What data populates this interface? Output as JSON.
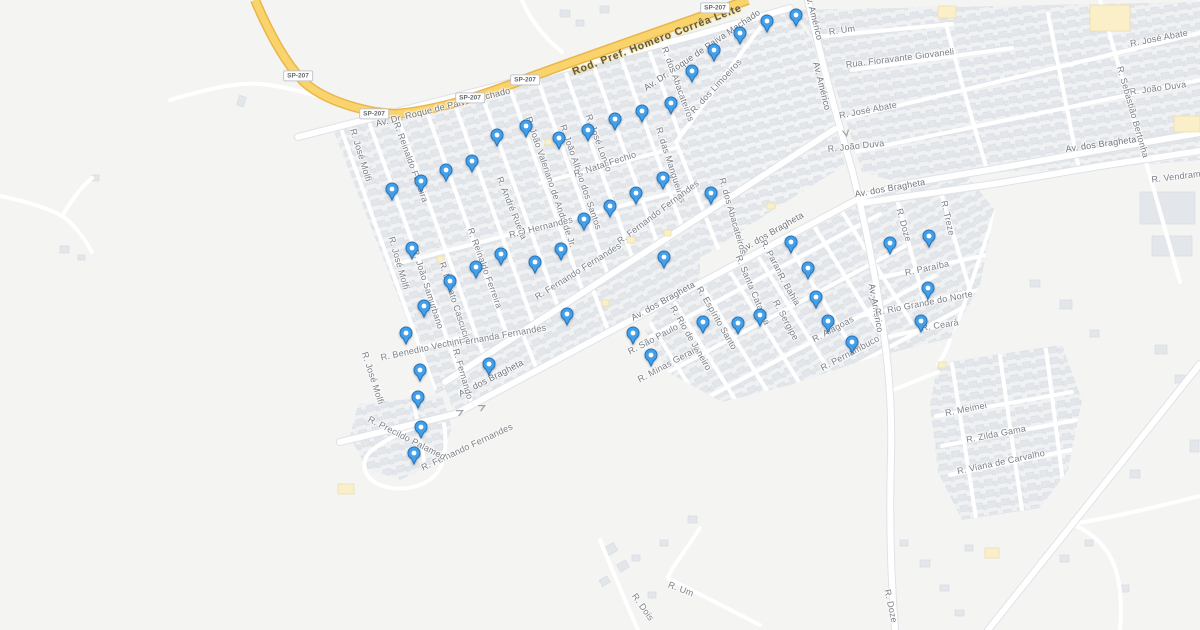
{
  "map": {
    "colors": {
      "land": "#F4F5F2",
      "block": "#EFF1F3",
      "building": "#E3E6EA",
      "building_stroke": "#D8DCE1",
      "road": "#FFFFFF",
      "road_casing": "#DFE2E6",
      "highway_fill": "#F9D46C",
      "highway_casing": "#EBB54B",
      "poi_building": "#FAEFC9",
      "label": "#7B7F87",
      "highway_label": "#5D5944",
      "marker_fill": "#43A0E8",
      "marker_stroke": "#2273BF",
      "marker_dot": "#FFFFFF"
    },
    "shields": [
      {
        "text": "SP-207",
        "x": 298,
        "y": 76
      },
      {
        "text": "SP-207",
        "x": 374,
        "y": 114
      },
      {
        "text": "SP-207",
        "x": 470,
        "y": 98
      },
      {
        "text": "SP-207",
        "x": 525,
        "y": 80
      },
      {
        "text": "SP-207",
        "x": 715,
        "y": 8
      }
    ],
    "labels": [
      {
        "text": "Rod. Pref. Homero Corrêa Leite",
        "x": 657,
        "y": 40,
        "r": -21,
        "kind": "highway"
      },
      {
        "text": "Av. Dr. Roque de Paiva Machado",
        "x": 443,
        "y": 107,
        "r": -14,
        "kind": "avenue"
      },
      {
        "text": "Av. Dr. Roque de Paiva Machado",
        "x": 702,
        "y": 50,
        "r": -34,
        "kind": "avenue"
      },
      {
        "text": "Av. dos Bragheta",
        "x": 491,
        "y": 378,
        "r": -27,
        "kind": "avenue"
      },
      {
        "text": "Av. dos Bragheta",
        "x": 663,
        "y": 301,
        "r": -29,
        "kind": "avenue"
      },
      {
        "text": "Av. dos Bragheta",
        "x": 772,
        "y": 232,
        "r": -30,
        "kind": "avenue"
      },
      {
        "text": "Av. dos Bragheta",
        "x": 890,
        "y": 188,
        "r": -10,
        "kind": "avenue"
      },
      {
        "text": "Av. dos Bragheta",
        "x": 1101,
        "y": 144,
        "r": -8,
        "kind": "avenue"
      },
      {
        "text": "Av. Américo",
        "x": 814,
        "y": 16,
        "r": 76,
        "kind": "avenue"
      },
      {
        "text": "Av. Américo",
        "x": 822,
        "y": 86,
        "r": 76,
        "kind": "avenue"
      },
      {
        "text": "Av. Américo",
        "x": 876,
        "y": 308,
        "r": 80,
        "kind": "avenue"
      },
      {
        "text": "R. José Molfi",
        "x": 361,
        "y": 155,
        "r": 73,
        "kind": "street"
      },
      {
        "text": "R. José Molfi",
        "x": 399,
        "y": 263,
        "r": 74,
        "kind": "street"
      },
      {
        "text": "R. José Molfi",
        "x": 373,
        "y": 378,
        "r": 72,
        "kind": "street"
      },
      {
        "text": "R. Reinaldo Ferreira",
        "x": 411,
        "y": 162,
        "r": 70,
        "kind": "street"
      },
      {
        "text": "R. Reinaldo Ferreira",
        "x": 485,
        "y": 268,
        "r": 70,
        "kind": "street"
      },
      {
        "text": "R. João Samurbano",
        "x": 428,
        "y": 289,
        "r": 72,
        "kind": "street"
      },
      {
        "text": "R. Donato Cascucio",
        "x": 455,
        "y": 302,
        "r": 72,
        "kind": "street"
      },
      {
        "text": "R. André Rueda",
        "x": 512,
        "y": 208,
        "r": 68,
        "kind": "street"
      },
      {
        "text": "R. João Valeriano de Andrade Jr.",
        "x": 551,
        "y": 182,
        "r": 71,
        "kind": "street"
      },
      {
        "text": "R. João Albino dos Santos",
        "x": 581,
        "y": 177,
        "r": 71,
        "kind": "street"
      },
      {
        "text": "R. José Longo",
        "x": 599,
        "y": 143,
        "r": 70,
        "kind": "street"
      },
      {
        "text": "R. Natal Fechio",
        "x": 605,
        "y": 164,
        "r": -18,
        "kind": "street"
      },
      {
        "text": "R. das Mangueiras",
        "x": 671,
        "y": 165,
        "r": 72,
        "kind": "street"
      },
      {
        "text": "R. dos Abacateiros",
        "x": 678,
        "y": 84,
        "r": 70,
        "kind": "street"
      },
      {
        "text": "R. dos Abacateiros",
        "x": 733,
        "y": 216,
        "r": 74,
        "kind": "street"
      },
      {
        "text": "R. dos Limoeiros",
        "x": 716,
        "y": 86,
        "r": -47,
        "kind": "street"
      },
      {
        "text": "R. J Hernandes",
        "x": 541,
        "y": 227,
        "r": -14,
        "kind": "street"
      },
      {
        "text": "R. Fernanda Fernandes",
        "x": 497,
        "y": 336,
        "r": -10,
        "kind": "street"
      },
      {
        "text": "R. Fernando Fernandes",
        "x": 578,
        "y": 271,
        "r": -32,
        "kind": "street"
      },
      {
        "text": "R. Fernando Fernandes",
        "x": 658,
        "y": 212,
        "r": -37,
        "kind": "street"
      },
      {
        "text": "R. Fernando Fernandes",
        "x": 467,
        "y": 447,
        "r": -25,
        "kind": "street"
      },
      {
        "text": "R. Benedito Vechini",
        "x": 421,
        "y": 349,
        "r": -12,
        "kind": "street"
      },
      {
        "text": "R. Fernando",
        "x": 463,
        "y": 374,
        "r": 74,
        "kind": "street"
      },
      {
        "text": "R. Precildo Palamed",
        "x": 407,
        "y": 438,
        "r": 27,
        "kind": "street"
      },
      {
        "text": "R. Um",
        "x": 842,
        "y": 30,
        "r": -8,
        "kind": "street"
      },
      {
        "text": "Rua. Fioravante Giovaneli",
        "x": 900,
        "y": 58,
        "r": -7,
        "kind": "street"
      },
      {
        "text": "R. José Abate",
        "x": 868,
        "y": 110,
        "r": -11,
        "kind": "street"
      },
      {
        "text": "R. José Abate",
        "x": 1159,
        "y": 38,
        "r": -11,
        "kind": "street"
      },
      {
        "text": "R. João Duva",
        "x": 856,
        "y": 146,
        "r": -6,
        "kind": "street"
      },
      {
        "text": "R. João Duva",
        "x": 1158,
        "y": 88,
        "r": -8,
        "kind": "street"
      },
      {
        "text": "R. Sebastião Bertonha",
        "x": 1133,
        "y": 112,
        "r": 74,
        "kind": "street"
      },
      {
        "text": "R. Vendramim",
        "x": 1181,
        "y": 176,
        "r": -7,
        "kind": "street"
      },
      {
        "text": "R. Doze",
        "x": 904,
        "y": 225,
        "r": 74,
        "kind": "street"
      },
      {
        "text": "R. Treze",
        "x": 948,
        "y": 218,
        "r": 77,
        "kind": "street"
      },
      {
        "text": "R. Paraná",
        "x": 773,
        "y": 259,
        "r": 62,
        "kind": "street"
      },
      {
        "text": "R. Santa Catarina",
        "x": 753,
        "y": 290,
        "r": 67,
        "kind": "street"
      },
      {
        "text": "R. Bahia",
        "x": 789,
        "y": 289,
        "r": 60,
        "kind": "street"
      },
      {
        "text": "R. Sergipe",
        "x": 786,
        "y": 320,
        "r": 62,
        "kind": "street"
      },
      {
        "text": "R. Espírito Santo",
        "x": 717,
        "y": 318,
        "r": 60,
        "kind": "street"
      },
      {
        "text": "R. Rio de Janeiro",
        "x": 691,
        "y": 338,
        "r": 60,
        "kind": "street"
      },
      {
        "text": "R. São Paulo",
        "x": 653,
        "y": 339,
        "r": -28,
        "kind": "street"
      },
      {
        "text": "R. Minas Gerais",
        "x": 668,
        "y": 364,
        "r": -28,
        "kind": "street"
      },
      {
        "text": "R. Paraíba",
        "x": 927,
        "y": 268,
        "r": -12,
        "kind": "street"
      },
      {
        "text": "R. Rio Grande do Norte",
        "x": 924,
        "y": 303,
        "r": -11,
        "kind": "street"
      },
      {
        "text": "R. Ceará",
        "x": 940,
        "y": 325,
        "r": -9,
        "kind": "street"
      },
      {
        "text": "R. Alagoas",
        "x": 833,
        "y": 329,
        "r": -28,
        "kind": "street"
      },
      {
        "text": "R. Pernambuco",
        "x": 850,
        "y": 353,
        "r": -28,
        "kind": "street"
      },
      {
        "text": "R. Meimei",
        "x": 966,
        "y": 409,
        "r": -11,
        "kind": "street"
      },
      {
        "text": "R. Zilda Gama",
        "x": 996,
        "y": 434,
        "r": -11,
        "kind": "street"
      },
      {
        "text": "R. Viana de Carvalho",
        "x": 1001,
        "y": 462,
        "r": -12,
        "kind": "street"
      },
      {
        "text": "R. Um",
        "x": 681,
        "y": 589,
        "r": 21,
        "kind": "street"
      },
      {
        "text": "R. Dois",
        "x": 643,
        "y": 607,
        "r": 55,
        "kind": "street"
      },
      {
        "text": "R. Doze",
        "x": 891,
        "y": 606,
        "r": 78,
        "kind": "street"
      }
    ],
    "markers": [
      [
        796,
        15
      ],
      [
        767,
        21
      ],
      [
        740,
        33
      ],
      [
        714,
        50
      ],
      [
        692,
        71
      ],
      [
        671,
        103
      ],
      [
        642,
        111
      ],
      [
        615,
        119
      ],
      [
        588,
        130
      ],
      [
        559,
        138
      ],
      [
        526,
        126
      ],
      [
        497,
        135
      ],
      [
        472,
        161
      ],
      [
        446,
        170
      ],
      [
        421,
        181
      ],
      [
        392,
        189
      ],
      [
        412,
        248
      ],
      [
        424,
        306
      ],
      [
        406,
        333
      ],
      [
        450,
        281
      ],
      [
        476,
        267
      ],
      [
        501,
        254
      ],
      [
        535,
        262
      ],
      [
        561,
        249
      ],
      [
        584,
        219
      ],
      [
        610,
        206
      ],
      [
        636,
        193
      ],
      [
        663,
        178
      ],
      [
        664,
        257
      ],
      [
        567,
        314
      ],
      [
        633,
        333
      ],
      [
        420,
        370
      ],
      [
        418,
        397
      ],
      [
        421,
        427
      ],
      [
        414,
        453
      ],
      [
        489,
        364
      ],
      [
        711,
        193
      ],
      [
        791,
        242
      ],
      [
        808,
        268
      ],
      [
        816,
        297
      ],
      [
        828,
        321
      ],
      [
        852,
        342
      ],
      [
        760,
        315
      ],
      [
        738,
        323
      ],
      [
        703,
        322
      ],
      [
        651,
        355
      ],
      [
        890,
        243
      ],
      [
        929,
        236
      ],
      [
        928,
        288
      ],
      [
        921,
        321
      ]
    ]
  }
}
